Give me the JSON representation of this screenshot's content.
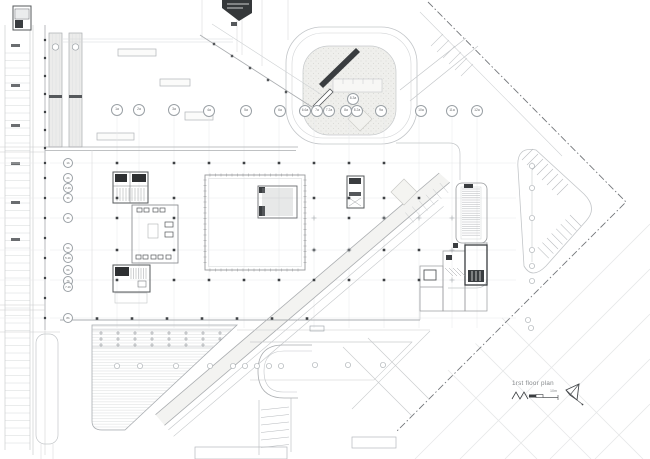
{
  "drawing": {
    "title": "1rst floor plan",
    "scale_label": "10m",
    "colors": {
      "line_light": "#c3c6c9",
      "line_medium": "#9aa0a5",
      "line_dark": "#55585b",
      "core_black": "#3a3d40",
      "label_gray": "#85888b"
    },
    "grid": {
      "a_row": [
        {
          "label": "1a",
          "x": 117,
          "y": 110
        },
        {
          "label": "2a",
          "x": 139,
          "y": 110
        },
        {
          "label": "3a",
          "x": 174,
          "y": 110
        },
        {
          "label": "4a",
          "x": 209,
          "y": 111
        },
        {
          "label": "5a",
          "x": 246,
          "y": 111
        },
        {
          "label": "6a",
          "x": 280,
          "y": 111
        },
        {
          "label": "6.6a",
          "x": 305,
          "y": 111
        },
        {
          "label": "7a",
          "x": 317,
          "y": 111
        },
        {
          "label": "7.2a",
          "x": 329,
          "y": 111
        },
        {
          "label": "8.3a",
          "x": 353,
          "y": 99
        },
        {
          "label": "8a",
          "x": 346,
          "y": 111
        },
        {
          "label": "8.2a",
          "x": 357,
          "y": 111
        },
        {
          "label": "9a",
          "x": 381,
          "y": 111
        },
        {
          "label": "10a",
          "x": 421,
          "y": 111
        },
        {
          "label": "11a",
          "x": 452,
          "y": 111
        },
        {
          "label": "12a",
          "x": 477,
          "y": 111
        }
      ],
      "b_col": [
        {
          "label": "1b",
          "x": 68,
          "y": 163
        },
        {
          "label": "2b",
          "x": 68,
          "y": 178
        },
        {
          "label": "2.2b",
          "x": 68,
          "y": 188
        },
        {
          "label": "3b",
          "x": 68,
          "y": 198
        },
        {
          "label": "4b",
          "x": 68,
          "y": 218
        },
        {
          "label": "5b",
          "x": 68,
          "y": 248
        },
        {
          "label": "5.2b",
          "x": 68,
          "y": 258
        },
        {
          "label": "6b",
          "x": 68,
          "y": 270
        },
        {
          "label": "7b",
          "x": 68,
          "y": 281
        },
        {
          "label": "7.2b",
          "x": 68,
          "y": 287
        },
        {
          "label": "8b",
          "x": 68,
          "y": 318
        }
      ]
    }
  }
}
